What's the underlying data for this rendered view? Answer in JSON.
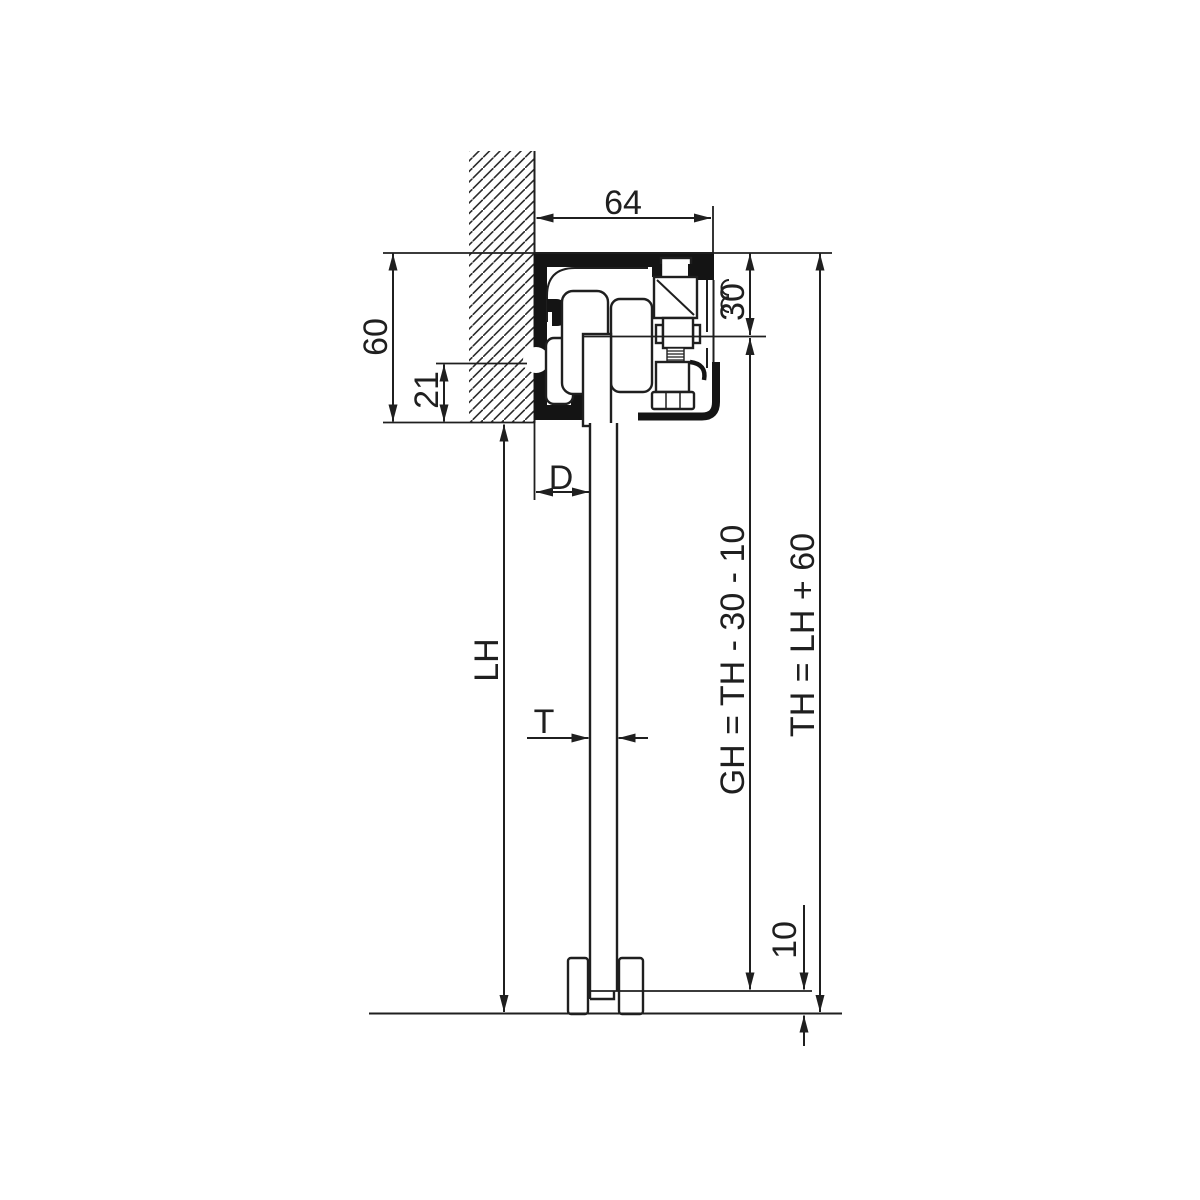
{
  "drawing": {
    "name": "Sliding door top-track vertical section with roller carriage, door panel and floor guide",
    "colors": {
      "line": "#1f1f1f",
      "background": "#ffffff"
    },
    "labels": {
      "track_width": "64",
      "track_height": "60",
      "fixing_height": "21",
      "top_clearance": "30",
      "wall_to_door": "D",
      "door_thickness": "T",
      "opening_height": "LH",
      "door_height_formula": "GH = TH - 30 - 10",
      "total_height_formula": "TH = LH + 60",
      "floor_clearance": "10"
    }
  }
}
